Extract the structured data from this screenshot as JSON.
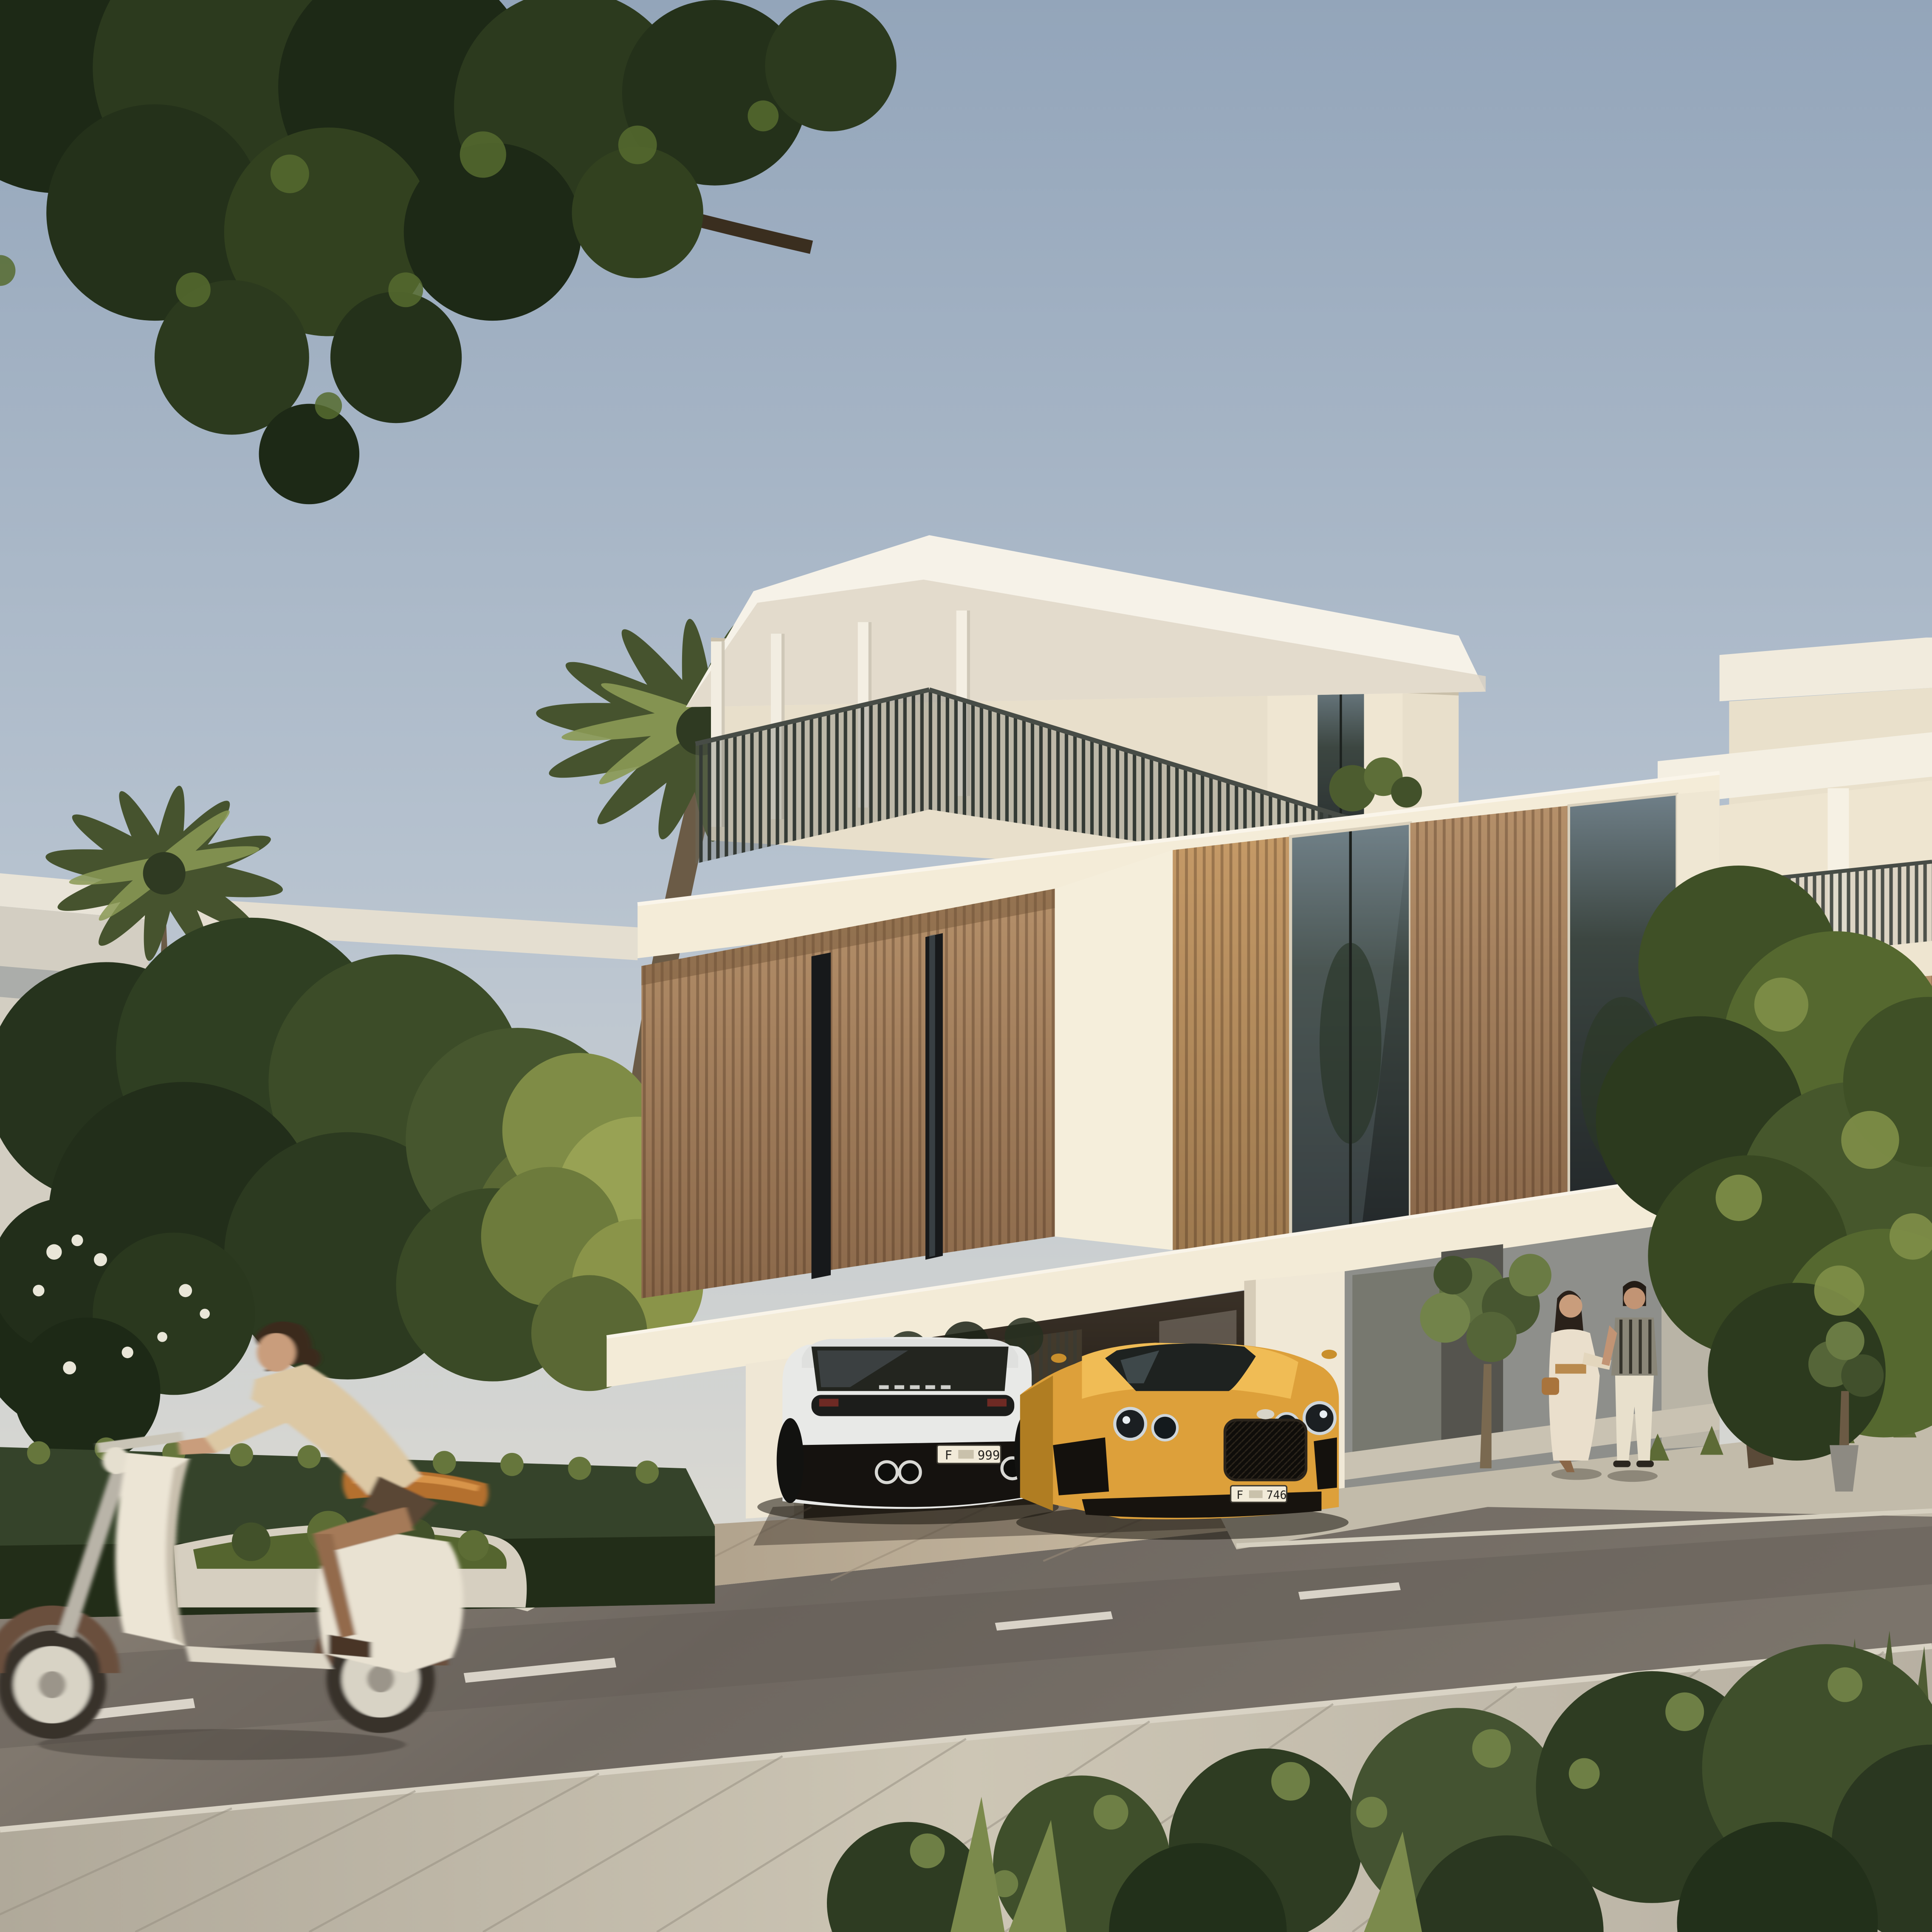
{
  "scene": {
    "kind": "photorealistic architectural rendering",
    "time_of_day": "golden hour",
    "subject": "modern two-storey villas on a residential street with carport, cars, scooter rider and walking couple"
  },
  "vehicles": {
    "suv": {
      "body_color_name": "white",
      "view": "rear",
      "plate": {
        "prefix": "F",
        "number": "999"
      }
    },
    "coupe": {
      "body_color_name": "golden",
      "view": "front",
      "plate": {
        "prefix": "F",
        "number": "746"
      }
    }
  },
  "people": {
    "scooter_rider": "woman riding a vintage cream scooter",
    "couple": [
      "woman in white dress with tan belt and handbag",
      "man in striped shirt and cream trousers"
    ]
  },
  "vegetation": [
    "overhanging tree canopy",
    "date palms",
    "sunlit street trees",
    "boxwood hedge",
    "olive trees",
    "foreground shrubs",
    "roof terrace plants"
  ],
  "colors": {
    "sky_top": "#93a5ba",
    "sky_mid": "#b6c2cf",
    "sky_low": "#d9d8d2",
    "cream_lit": "#f3ebd7",
    "cream_bright": "#f7f2e6",
    "cream_shade": "#e3d9c4",
    "cream_dark": "#cfc5b0",
    "wood_light": "#c59a67",
    "wood_mid": "#ab8459",
    "wood_dark": "#8a684a",
    "glass": "#2f3733",
    "glass_sky": "#6f7f88",
    "railing": "#3f443d",
    "carport_dark": "#1c1712",
    "carport_mid": "#3a3127",
    "car_white": "#e8e9e7",
    "car_gold": "#dda03a",
    "car_gold_dark": "#b07d22",
    "grille": "#0f0d0a",
    "plate_bg": "#f2ebd9",
    "plate_text": "#25231f",
    "road": "#7b746b",
    "road_light": "#8d8478",
    "sidewalk": "#bdb6a7",
    "sidewalk_lit": "#cdc6b5",
    "driveway": "#b9ab96",
    "driveway_lit": "#d2c3aa",
    "curb": "#d8d2c2",
    "hedge": "#35432a",
    "hedge_lit": "#66763c",
    "tree_dark": "#26331d",
    "tree_mid": "#3c4c28",
    "tree_lit": "#85924c",
    "palm_dark": "#46532e",
    "palm_lit": "#8b9a55",
    "skin": "#c99d7c",
    "rider_top": "#dcc8a4",
    "seat_orange": "#b4702f",
    "scooter_body": "#ece5d5",
    "scooter_brown": "#6b4f3e",
    "wall_grey": "#8e8f8b"
  }
}
